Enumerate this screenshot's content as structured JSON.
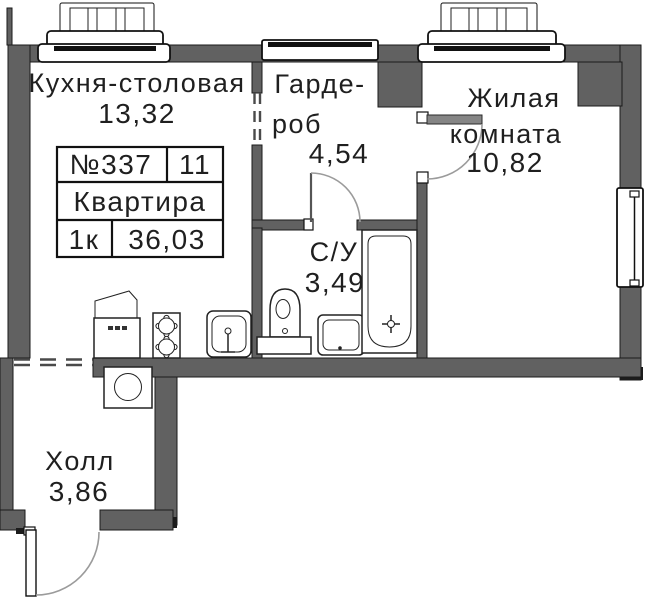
{
  "rooms": {
    "kitchen": {
      "name": "Кухня-столовая",
      "area": "13,32"
    },
    "wardrobe": {
      "name_line1": "Гарде-",
      "name_line2": "роб",
      "area": "4,54"
    },
    "living": {
      "name_line1": "Жилая",
      "name_line2": "комната",
      "area": "10,82"
    },
    "bathroom": {
      "name": "С/У",
      "area": "3,49"
    },
    "hall": {
      "name": "Холл",
      "area": "3,86"
    }
  },
  "info_table": {
    "apartment_number": "№337",
    "position_number": "11",
    "type_label": "Квартира",
    "rooms_count": "1к",
    "total_area": "36,03"
  },
  "colors": {
    "wall": "#616161",
    "text": "#1f1f1f",
    "fixture_outline": "#222222"
  }
}
